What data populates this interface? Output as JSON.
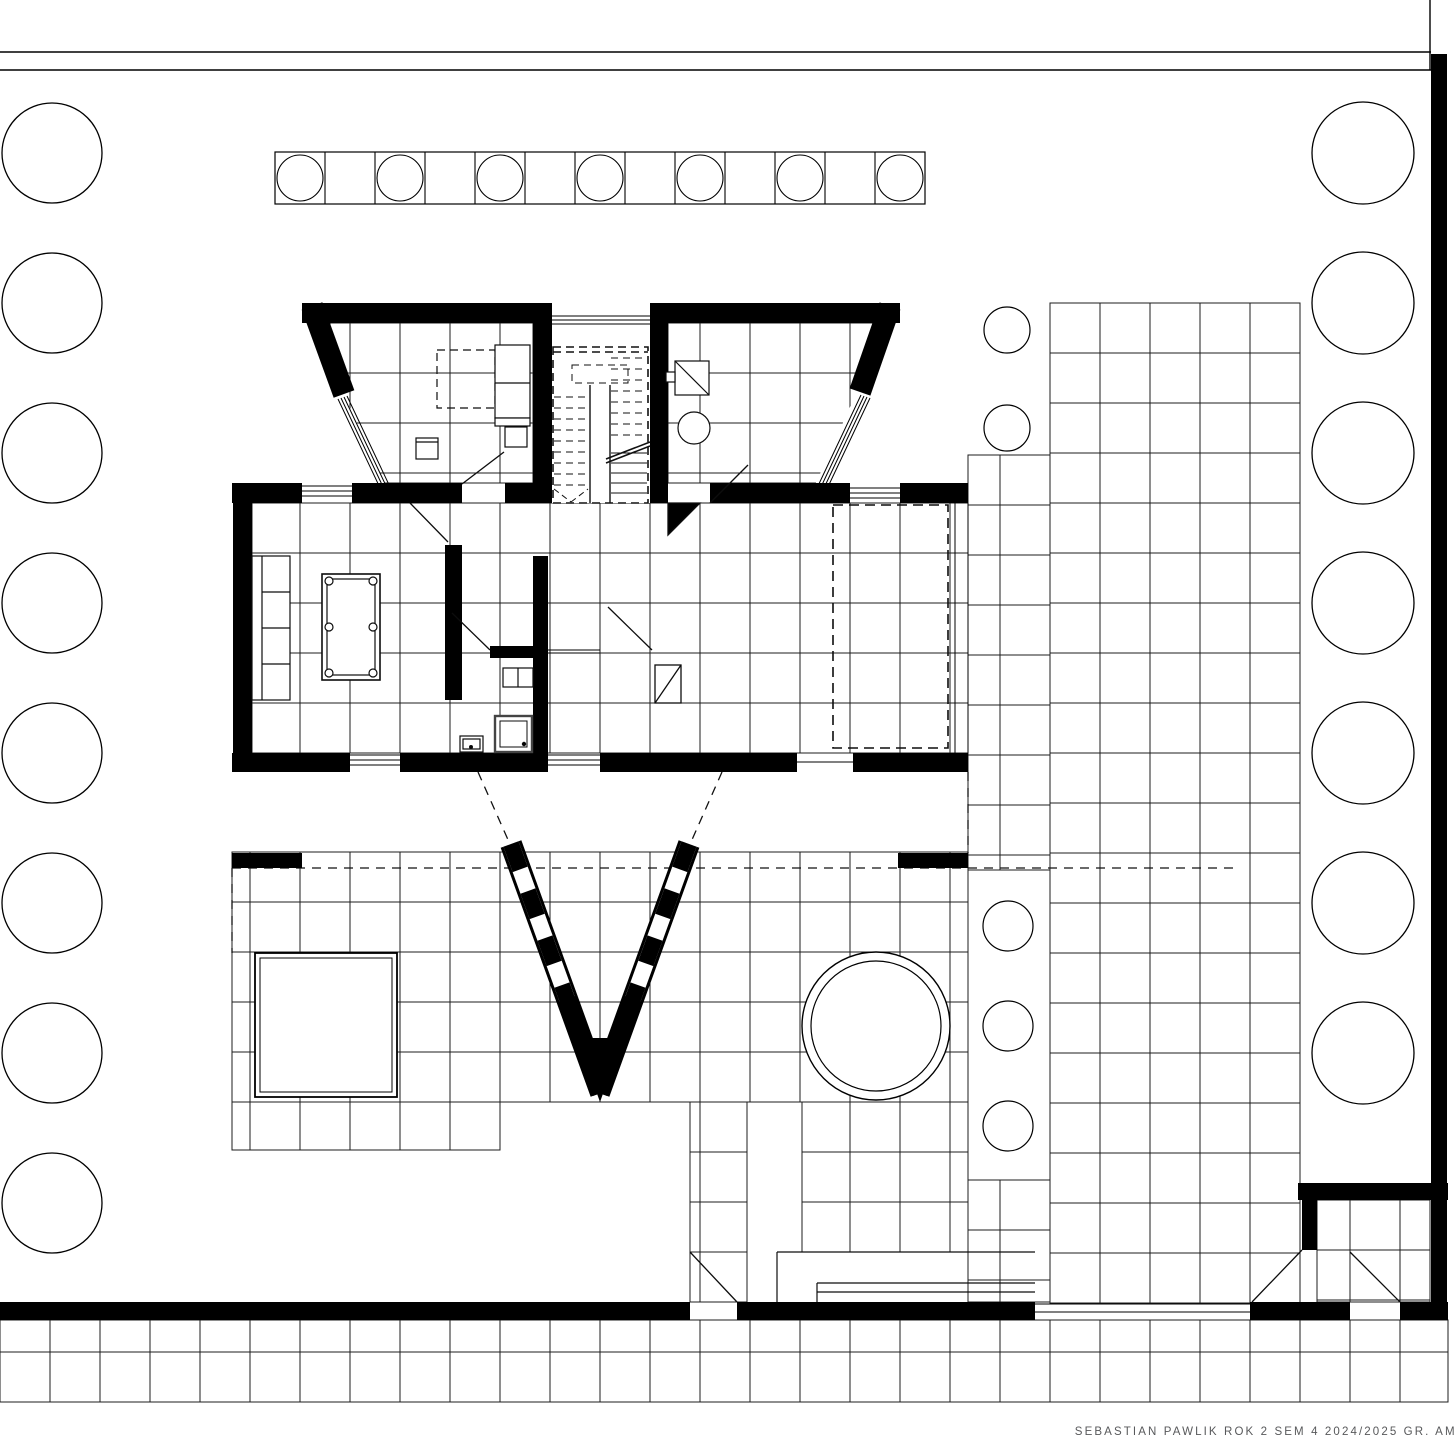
{
  "title_block": {
    "text": "SEBASTIAN PAWLIK ROK 2 SEM 4 2024/2025 GR. AM",
    "color": "#58595b"
  },
  "colors": {
    "ink": "#000000",
    "tile_line": "#1c1c1c",
    "furniture_line": "#0d0d0d",
    "background": "#ffffff"
  },
  "frame": {
    "top_line1_y": 52,
    "top_line2_y": 70,
    "right_bar": {
      "x": 1431,
      "y": 54,
      "w": 16,
      "h": 1266
    }
  },
  "trees_left": {
    "cx": 52,
    "r": 50,
    "start_cy": 153,
    "spacing": 150,
    "count": 8
  },
  "trees_right": {
    "cx": 1363,
    "r": 51,
    "start_cy": 153,
    "spacing": 150,
    "count": 7
  },
  "planter_strip": {
    "x": 275,
    "y": 152,
    "cell": 50,
    "count": 13,
    "height": 52,
    "circle_r": 23
  },
  "planter_circles": {
    "cx": 1007,
    "r": 23,
    "cys": [
      330,
      428
    ]
  },
  "island_circles": {
    "cx": 1008,
    "r": 25,
    "cys": [
      926,
      1026,
      1126
    ]
  },
  "hot_tub": {
    "cx": 876,
    "cy": 1026,
    "r_outer": 74,
    "r_inner": 65
  },
  "pool": {
    "x": 255,
    "y": 953,
    "w": 142,
    "h": 144,
    "inset": 5
  },
  "tile_zones": [
    {
      "x": 232,
      "y": 852,
      "w": 736,
      "h": 250
    },
    {
      "x": 232,
      "y": 1102,
      "w": 268,
      "h": 48
    },
    {
      "x": 690,
      "y": 1102,
      "w": 57,
      "h": 200
    },
    {
      "x": 802,
      "y": 1102,
      "w": 166,
      "h": 150
    },
    {
      "x": 968,
      "y": 455,
      "w": 82,
      "h": 415
    },
    {
      "x": 968,
      "y": 1180,
      "w": 82,
      "h": 122
    },
    {
      "x": 1050,
      "y": 303,
      "w": 250,
      "h": 1000
    },
    {
      "x": 252,
      "y": 503,
      "w": 716,
      "h": 250
    },
    {
      "x": 330,
      "y": 323,
      "w": 203,
      "h": 160
    },
    {
      "x": 668,
      "y": 323,
      "w": 232,
      "h": 160
    },
    {
      "x": 1317,
      "y": 1200,
      "w": 113,
      "h": 102
    },
    {
      "x": 0,
      "y": 1320,
      "w": 1448,
      "h": 32,
      "ch": 32
    },
    {
      "x": 0,
      "y": 1352,
      "w": 1448,
      "h": 50
    }
  ],
  "stairs": {
    "left_treads": {
      "x1": 554,
      "x2": 589,
      "y0": 397,
      "step": 11,
      "count": 9,
      "dashed": true
    },
    "right_treads_dashed": {
      "x1": 611,
      "x2": 647,
      "y0": 358,
      "step": 11,
      "count": 8,
      "dashed": true
    },
    "right_treads_solid": {
      "x1": 611,
      "x2": 647,
      "y0": 453,
      "step": 10,
      "count": 5,
      "dashed": false
    }
  }
}
